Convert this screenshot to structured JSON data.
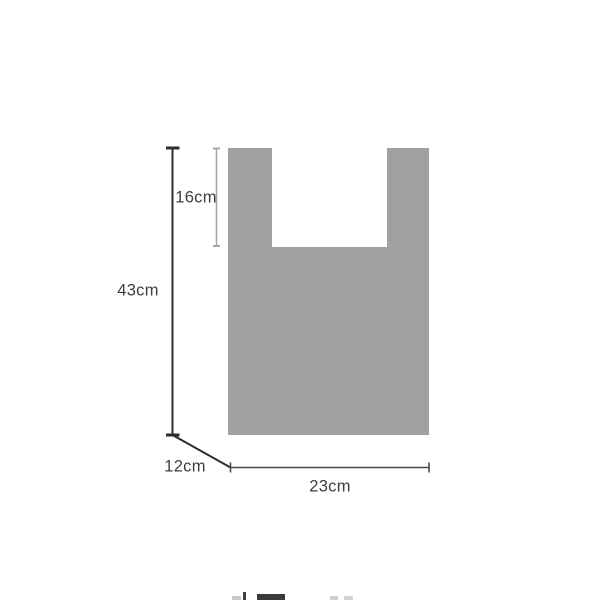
{
  "diagram": {
    "type": "product-dimension-diagram",
    "subject": "t-shirt-style vest bag silhouette, front view with depth indicator",
    "measurements": {
      "total_height": "43cm",
      "handle_opening_depth": "16cm",
      "gusset_depth": "12cm",
      "bottom_width": "23cm"
    },
    "colors": {
      "bag_fill": "#a1a1a1",
      "cutout_fill": "#ffffff",
      "line_dark": "#2d2d2d",
      "line_light": "#a8a8a8",
      "line_mid": "#4c4c4c",
      "text": "#3e3e3e",
      "background": "#ffffff"
    }
  }
}
